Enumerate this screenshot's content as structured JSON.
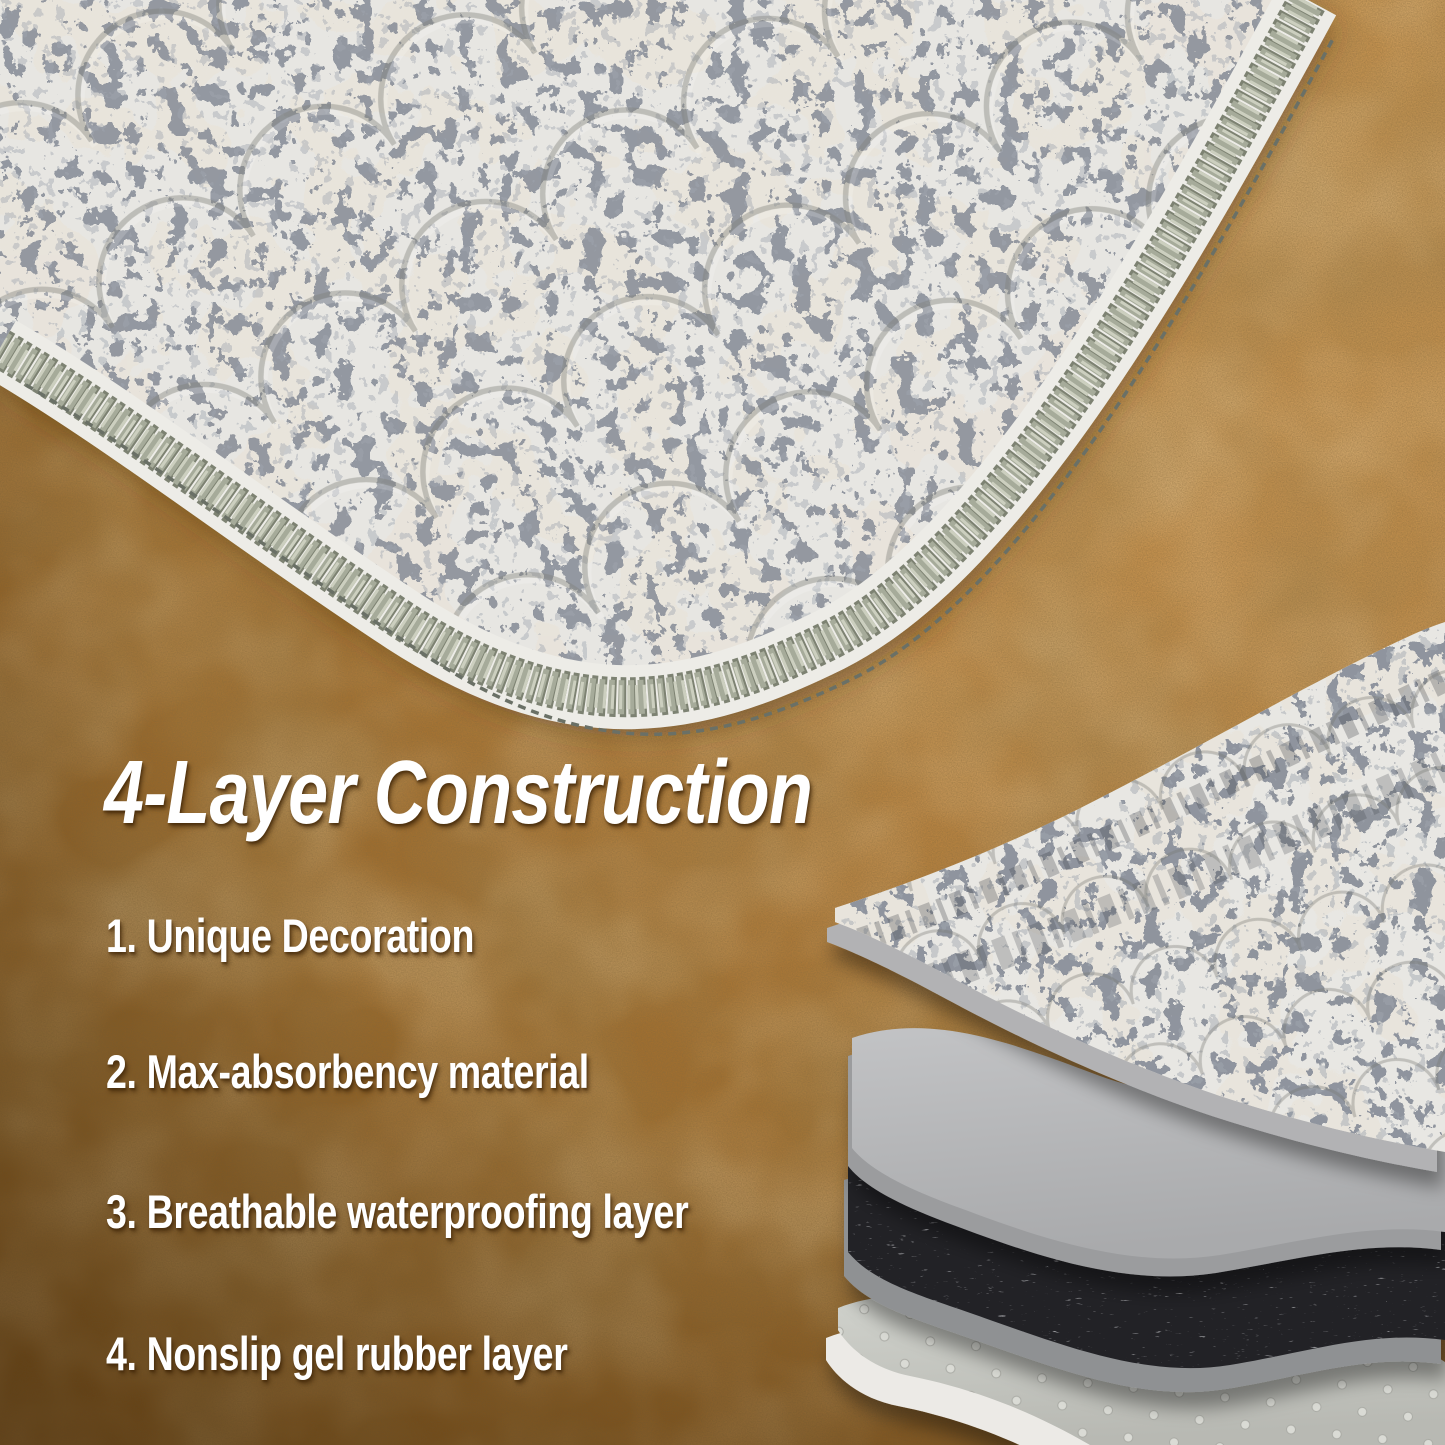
{
  "headline": {
    "text": "4-Layer Construction"
  },
  "features": [
    {
      "text": "1. Unique Decoration"
    },
    {
      "text": "2. Max-absorbency material"
    },
    {
      "text": "3. Breathable waterproofing layer"
    },
    {
      "text": "4. Nonslip gel rubber layer"
    }
  ],
  "diagram": {
    "layers": [
      {
        "name": "decor-fabric-layer"
      },
      {
        "name": "absorbent-material-layer"
      },
      {
        "name": "waterproof-membrane-layer"
      },
      {
        "name": "nonslip-gel-rubber-layer"
      }
    ]
  },
  "colors": {
    "floor_tan": "#b5813f",
    "floor_shadow": "#7a5420",
    "text_white": "#ffffff",
    "mat_fabric_base": "#e9e8e4",
    "mat_motif_dark": "#41454b",
    "mat_patch_beige": "#ccc5b5",
    "serge_edge_sage": "#a6ab9a",
    "absorbent_gray": "#b6b7b9",
    "waterproof_dark": "#232327",
    "nonslip_gray": "#c8c9c4"
  }
}
